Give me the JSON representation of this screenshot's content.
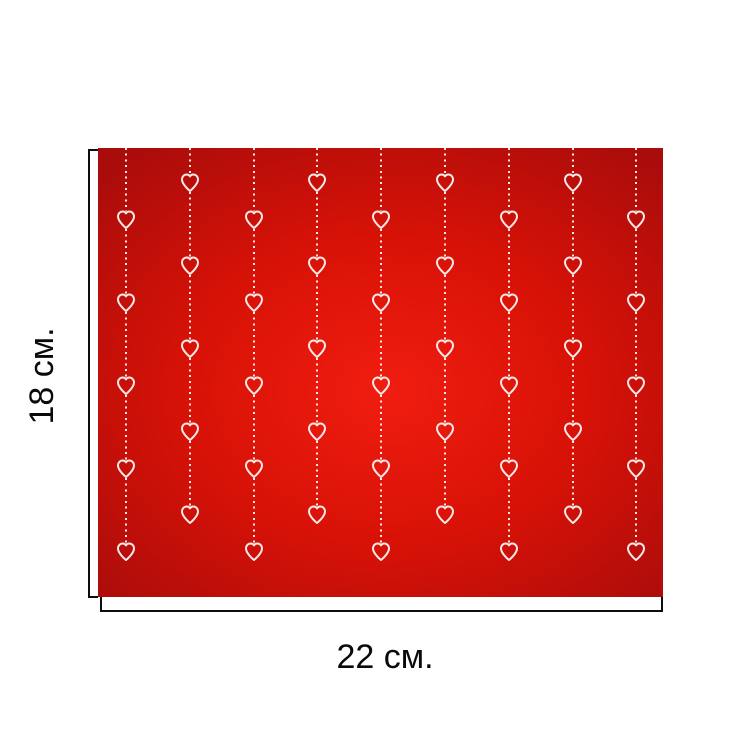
{
  "figure": {
    "height_label": "18 см.",
    "width_label": "22 см."
  },
  "swatch": {
    "background_center_color": "#f01d10",
    "background_mid_color": "#d81207",
    "background_edge_color": "#a80c0b",
    "pattern_color": "#fbe9e8",
    "columns": 9,
    "first_column_x": 28,
    "column_spacing": 63.8,
    "hearts_per_column": 5,
    "heart_row_spacing": 83,
    "first_heart_y_odd_numbered_columns": 72,
    "first_heart_y_even_numbered_columns": 35
  },
  "annotation": {
    "line_color": "#0d0d0d"
  }
}
